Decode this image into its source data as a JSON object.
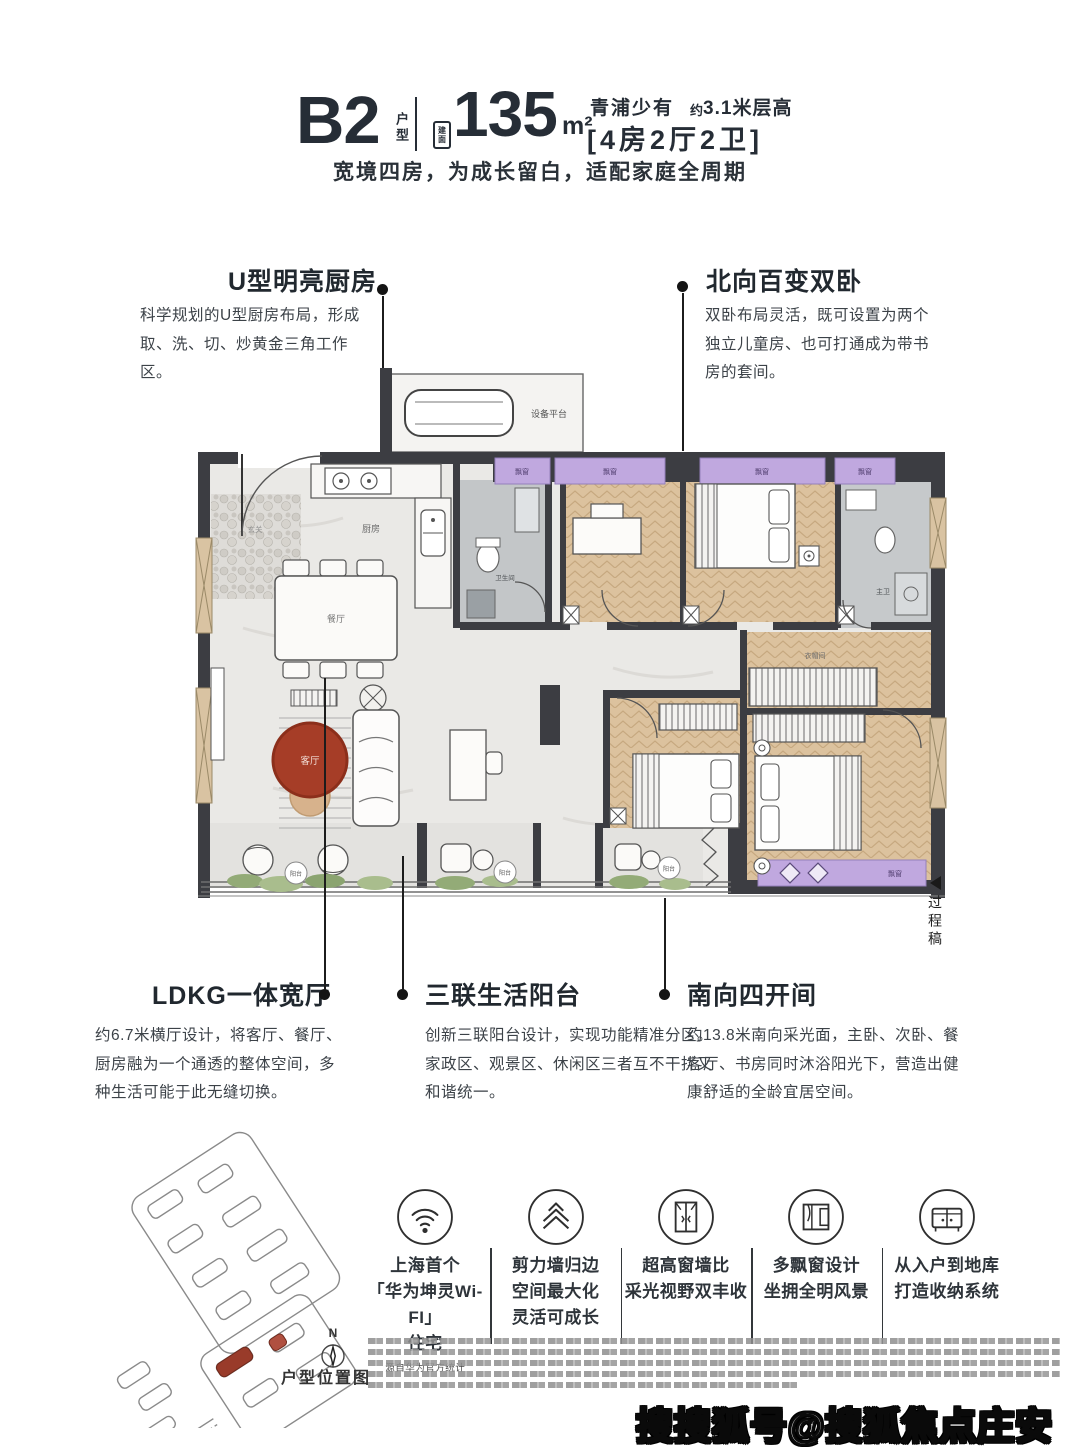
{
  "header": {
    "unit": "B2",
    "unit_suffix": "户型",
    "area_badge": "建面",
    "area_value": "135",
    "area_unit": "m²",
    "tagline_left": "青浦少有",
    "tagline_approx": "约",
    "tagline_right": "3.1米层高",
    "layout_spec": "[4房2厅2卫]",
    "subtitle": "宽境四房，为成长留白，适配家庭全周期"
  },
  "callouts": {
    "kitchen": {
      "title": "U型明亮厨房",
      "body": "科学规划的U型厨房布局，形成取、洗、切、炒黄金三角工作区。"
    },
    "north_bedrooms": {
      "title": "北向百变双卧",
      "body": "双卧布局灵活，既可设置为两个独立儿童房、也可打通成为带书房的套间。"
    },
    "ldkg": {
      "title": "LDKG一体宽厅",
      "body": "约6.7米横厅设计，将客厅、餐厅、厨房融为一个通透的整体空间，多种生活可能于此无缝切换。"
    },
    "triple_balcony": {
      "title": "三联生活阳台",
      "body": "创新三联阳台设计，实现功能精准分区。家政区、观景区、休闲区三者互不干扰又和谐统一。"
    },
    "south_bays": {
      "title": "南向四开间",
      "body": "约13.8米南向采光面，主卧、次卧、餐客厅、书房同时沐浴阳光下，营造出健康舒适的全龄宜居空间。"
    }
  },
  "floorplan": {
    "rooms": {
      "kitchen": "厨房",
      "entry": "玄关",
      "dining": "餐厅",
      "living": "客厅",
      "balcony": "阳台",
      "bathroom": "卫生间",
      "master_bath": "主卫",
      "closet": "衣帽间",
      "bay_window": "飘窗",
      "equipment_platform": "设备平台"
    },
    "draft_note": "过程稿"
  },
  "features": [
    {
      "icon": "wifi-icon",
      "lines": [
        "上海首个",
        "「华为坤灵Wi-FI」",
        "住宅"
      ],
      "note": "源自华为官方统计"
    },
    {
      "icon": "shear-wall-icon",
      "lines": [
        "剪力墙归边",
        "空间最大化",
        "灵活可成长"
      ],
      "note": ""
    },
    {
      "icon": "tall-window-icon",
      "lines": [
        "超高窗墙比",
        "采光视野双丰收"
      ],
      "note": ""
    },
    {
      "icon": "bay-window-icon",
      "lines": [
        "多飘窗设计",
        "坐拥全明风景"
      ],
      "note": ""
    },
    {
      "icon": "storage-icon",
      "lines": [
        "从入户到地库",
        "打造收纳系统"
      ],
      "note": ""
    }
  ],
  "siteplan": {
    "compass": "N",
    "label": "户型位置图"
  },
  "watermark": "搜搜狐号@搜狐焦点庄安站",
  "colors": {
    "accent_red": "#a63d27",
    "bay_purple": "#c0a8df",
    "wall_dark": "#3c3d42",
    "wood": "#dcc29e",
    "text_dark": "#262d36"
  }
}
